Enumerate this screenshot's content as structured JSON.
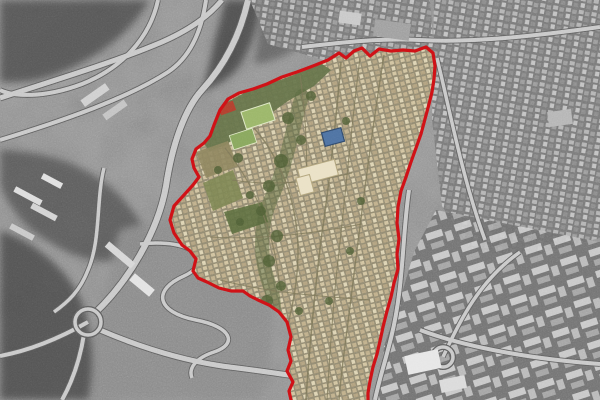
{
  "style": {
    "boundary_color": "#d01217",
    "boundary_width": "3.2",
    "district_base": "#cfc09a",
    "district_street": "#7d7757",
    "grass_band": "#66744a",
    "field_green_1": "#9cb76a",
    "field_green_2": "#8aa85e",
    "terrace_brown": "#8f865e",
    "terrace_green": "#7d8652",
    "park_green": "#5c6e3e",
    "tree_green": "#4f5f35",
    "ravine_green": "#55653a",
    "landmark_blue": "#4e73a3",
    "landmark_blue_edge": "#2f4a6e",
    "landmark_cream": "#eae1c6",
    "landmark_cream_edge": "#b3a67e",
    "landmark_red_roof": "#b2402e",
    "base_gray": "#9a9a9a",
    "road_light": "#c8c8c8",
    "road_casing": "#5e5e5e",
    "white_building": "#e8e8e8"
  },
  "boundary": {
    "points": "291,400 289,391 293,382 287,371 291,361 288,350 291,337 287,322 279,312 269,305 258,300 250,296 243,291 231,291 219,288 207,282 198,278 193,271 196,259 190,251 182,245 174,233 170,220 174,206 184,195 193,185 199,177 194,168 192,159 196,149 204,143 210,136 214,125 220,110 228,99 239,93 253,89 267,84 282,77 297,72 313,66 328,60 339,53 346,58 354,51 362,48 370,56 379,49 391,51 403,50 415,51 426,47 433,53 435,66 434,79 432,92 429,104 425,119 421,134 416,148 411,162 406,177 401,191 398,207 397,223 399,239 397,254 398,269 394,283 391,297 387,311 383,327 380,341 377,354 373,367 370,381 368,393 368,400"
  },
  "district": {
    "grass_band_d": "M203,141 L210,121 L224,104 L244,93 L269,84 L299,73 L322,64 L331,70 L314,86 L288,101 L263,119 L243,133 L224,146 L209,151 Z",
    "field1_d": "M240.9,112.1 L269.5,102.8 L275.1,119.9 L246.5,129.2 Z",
    "field2_d": "M229.3,135.6 L252.1,128.2 L256.7,142.4 L233.9,149.8 Z",
    "terrace1_d": "M196,152 L228,141 L238,166 L206,178 Z",
    "terrace2_d": "M203,183 L233,170 L243,198 L213,211 Z",
    "park_d": "M224,212 L262,202 L268,222 L232,234 Z",
    "ravine_d": "M302,96 C292,130 286,168 271,199 C259,227 259,259 271,289 C277,307 273,329 263,345",
    "blue_building_d": "M321.5,132.8 L340.9,127.7 L344.5,141.2 L325.2,146.4 Z",
    "cream_complex_a_d": "M297.6,169.2 L334.3,159.4 L338.4,174.8 L301.7,184.7 Z",
    "cream_complex_b_d": "M295.9,178.1 L309.4,174.5 L314.1,191.9 L300.6,195.5 Z",
    "red_roof_building_d": "M217.8,106 L232.8,100.6 L236.2,110 L221.2,115.4 Z",
    "streets": [
      {
        "name": "district-street-main",
        "d": "M341,62 C336,120 330,180 321,240 C314,300 309,350 306,400",
        "w": 1.6
      },
      {
        "name": "district-street-east",
        "d": "M384,55 C372,130 362,210 352,290 C346,340 341,372 339,400",
        "w": 1.4
      },
      {
        "name": "district-street-mid",
        "d": "M360,58 C352,120 346,190 338,260 C333,305 330,350 327,400",
        "w": 1.1
      },
      {
        "name": "district-street-west",
        "d": "M254,128 C282,160 298,205 298,252 C298,290 288,330 276,362",
        "w": 1.4
      },
      {
        "name": "district-street-sw",
        "d": "M225,148 C255,185 276,235 280,290",
        "w": 1.1
      },
      {
        "name": "district-cross-1",
        "d": "M232,180 C270,186 310,183 352,173",
        "w": 1
      },
      {
        "name": "district-cross-2",
        "d": "M210,237 C260,240 310,234 362,224",
        "w": 1
      },
      {
        "name": "district-cross-3",
        "d": "M220,280 C265,292 315,296 370,300",
        "w": 1
      },
      {
        "name": "district-cross-4",
        "d": "M300,75 C305,110 308,150 306,190",
        "w": 1
      }
    ],
    "vegetation_spots": [
      [
        288,
        118,
        6
      ],
      [
        301,
        140,
        5
      ],
      [
        281,
        161,
        7
      ],
      [
        269,
        186,
        6
      ],
      [
        261,
        211,
        5
      ],
      [
        277,
        236,
        6
      ],
      [
        269,
        261,
        6
      ],
      [
        281,
        286,
        5
      ],
      [
        267,
        301,
        6
      ],
      [
        261,
        326,
        5
      ],
      [
        299,
        311,
        4
      ],
      [
        329,
        301,
        4
      ],
      [
        350,
        251,
        4
      ],
      [
        361,
        201,
        4
      ],
      [
        346,
        121,
        4
      ],
      [
        311,
        96,
        5
      ],
      [
        238,
        158,
        5
      ],
      [
        218,
        170,
        4
      ],
      [
        250,
        195,
        4
      ],
      [
        240,
        222,
        4
      ]
    ]
  },
  "surroundings": {
    "hills": [
      {
        "name": "hillside-northwest",
        "d": "M0,0 L150,0 C130,35 95,60 55,75 C35,82 15,84 0,82 Z",
        "fill": "#4a4a4a",
        "op": "0.8"
      },
      {
        "name": "ravine-north",
        "d": "M225,0 L262,0 C258,30 250,52 236,70 C228,80 214,88 202,92 C210,60 218,28 225,0 Z",
        "fill": "#3f3f3f",
        "op": "0.8"
      },
      {
        "name": "hill-north-center",
        "d": "M262,0 L330,0 C322,24 308,42 288,54 C276,60 264,64 254,64 C258,40 260,20 262,0 Z",
        "fill": "#565656",
        "op": "0.7"
      },
      {
        "name": "hillside-west",
        "d": "M0,150 C40,150 80,162 108,185 C130,202 148,228 152,252 C120,270 80,262 48,242 C20,225 5,200 0,185 Z",
        "fill": "#4e4e4e",
        "op": "0.75"
      },
      {
        "name": "barren-land-south",
        "d": "M120,230 C170,214 220,210 256,226 C280,288 276,340 262,400 L84,400 C80,360 92,330 104,300 C110,275 112,250 120,230 Z",
        "fill": "#8a8a8a",
        "op": "0.9"
      },
      {
        "name": "hill-southwest",
        "d": "M0,230 C30,240 60,262 76,290 C92,318 96,360 88,400 L0,400 Z",
        "fill": "#454545",
        "op": "0.8"
      }
    ],
    "city_regions": [
      {
        "name": "city-blocks-north",
        "points": "250,0 430,0 434,52 330,62 268,44",
        "pattern": "tile-gray"
      },
      {
        "name": "city-blocks-east",
        "points": "434,0 600,0 600,238 520,258 470,248 442,206 432,120 433,56",
        "pattern": "tile-gray"
      },
      {
        "name": "city-blocks-southeast",
        "points": "436,210 600,242 600,400 378,400 384,346 400,300 414,252",
        "pattern": "tile-big"
      }
    ],
    "roads": [
      {
        "name": "interchange-ramp-1",
        "d": "M0,98 C55,80 115,62 162,42 C196,27 212,12 222,0",
        "w": 5
      },
      {
        "name": "interchange-ramp-2",
        "d": "M0,140 C65,120 128,98 168,72 C192,56 202,28 206,0",
        "w": 4
      },
      {
        "name": "interchange-loop",
        "d": "M158,0 C150,38 122,68 82,84 C42,99 12,96 0,90",
        "w": 4
      },
      {
        "name": "highway-descent",
        "d": "M248,0 C240,36 224,66 202,90 C184,110 172,146 166,186 C158,232 128,282 94,314",
        "w": 6
      },
      {
        "name": "road-west",
        "d": "M88,322 C60,338 32,350 0,356",
        "w": 4
      },
      {
        "name": "road-southwest",
        "d": "M84,334 C80,360 72,382 62,400",
        "w": 4
      },
      {
        "name": "road-bottom",
        "d": "M100,330 C142,348 182,360 222,366 C268,372 312,377 358,389",
        "w": 5
      },
      {
        "name": "hairpin-road",
        "d": "M140,244 C196,238 214,262 184,276 C152,290 156,312 196,320 C232,327 238,344 214,352 C196,358 188,368 192,378",
        "w": 3.5
      },
      {
        "name": "road-east-boundary",
        "d": "M409,190 C402,238 404,286 391,338 C384,366 378,384 375,400",
        "w": 4
      },
      {
        "name": "road-north-grid",
        "d": "M302,47 C345,42 382,38 420,40 C472,43 535,36 600,27",
        "w": 4
      },
      {
        "name": "road-east-city",
        "d": "M437,58 C452,120 463,180 485,240",
        "w": 3.5
      },
      {
        "name": "road-left-curve",
        "d": "M104,168 C96,200 101,240 88,270 C80,291 68,302 54,312",
        "w": 3.5
      },
      {
        "name": "road-se-1",
        "d": "M420,330 C460,345 520,358 600,364",
        "w": 4
      },
      {
        "name": "road-se-2",
        "d": "M443,357 C460,320 480,280 520,252",
        "w": 3.5
      }
    ],
    "roundabouts": [
      {
        "name": "roundabout-west",
        "cx": 88,
        "cy": 322,
        "r": 13
      },
      {
        "name": "roundabout-southeast",
        "cx": 443,
        "cy": 357,
        "r": 10
      }
    ],
    "buildings": [
      {
        "cx": 28,
        "cy": 196,
        "w": 30,
        "h": 6,
        "rot": 28,
        "fill": "#dcdcdc"
      },
      {
        "cx": 44,
        "cy": 212,
        "w": 28,
        "h": 6,
        "rot": 28,
        "fill": "#d2d2d2"
      },
      {
        "cx": 22,
        "cy": 232,
        "w": 26,
        "h": 6,
        "rot": 28,
        "fill": "#c8c8c8"
      },
      {
        "cx": 52,
        "cy": 181,
        "w": 22,
        "h": 6,
        "rot": 28,
        "fill": "#e0e0e0"
      },
      {
        "cx": 120,
        "cy": 255,
        "w": 34,
        "h": 7,
        "rot": 40,
        "fill": "#d6d6d6"
      },
      {
        "cx": 142,
        "cy": 285,
        "w": 26,
        "h": 9,
        "rot": 40,
        "fill": "#e2e2e2"
      },
      {
        "cx": 95,
        "cy": 95,
        "w": 30,
        "h": 8,
        "rot": -35,
        "fill": "#cfcfcf"
      },
      {
        "cx": 115,
        "cy": 110,
        "w": 26,
        "h": 7,
        "rot": -35,
        "fill": "#c2c2c2"
      },
      {
        "cx": 423,
        "cy": 362,
        "w": 34,
        "h": 19,
        "rot": -12,
        "fill": "#e6e6e6"
      },
      {
        "cx": 453,
        "cy": 384,
        "w": 26,
        "h": 13,
        "rot": -12,
        "fill": "#dadada"
      },
      {
        "cx": 392,
        "cy": 30,
        "w": 36,
        "h": 17,
        "rot": 8,
        "fill": "#9e9e9e"
      },
      {
        "cx": 350,
        "cy": 18,
        "w": 22,
        "h": 12,
        "rot": 8,
        "fill": "#c8c8c8"
      },
      {
        "cx": 560,
        "cy": 118,
        "w": 24,
        "h": 15,
        "rot": -8,
        "fill": "#b4b4b4"
      }
    ]
  }
}
